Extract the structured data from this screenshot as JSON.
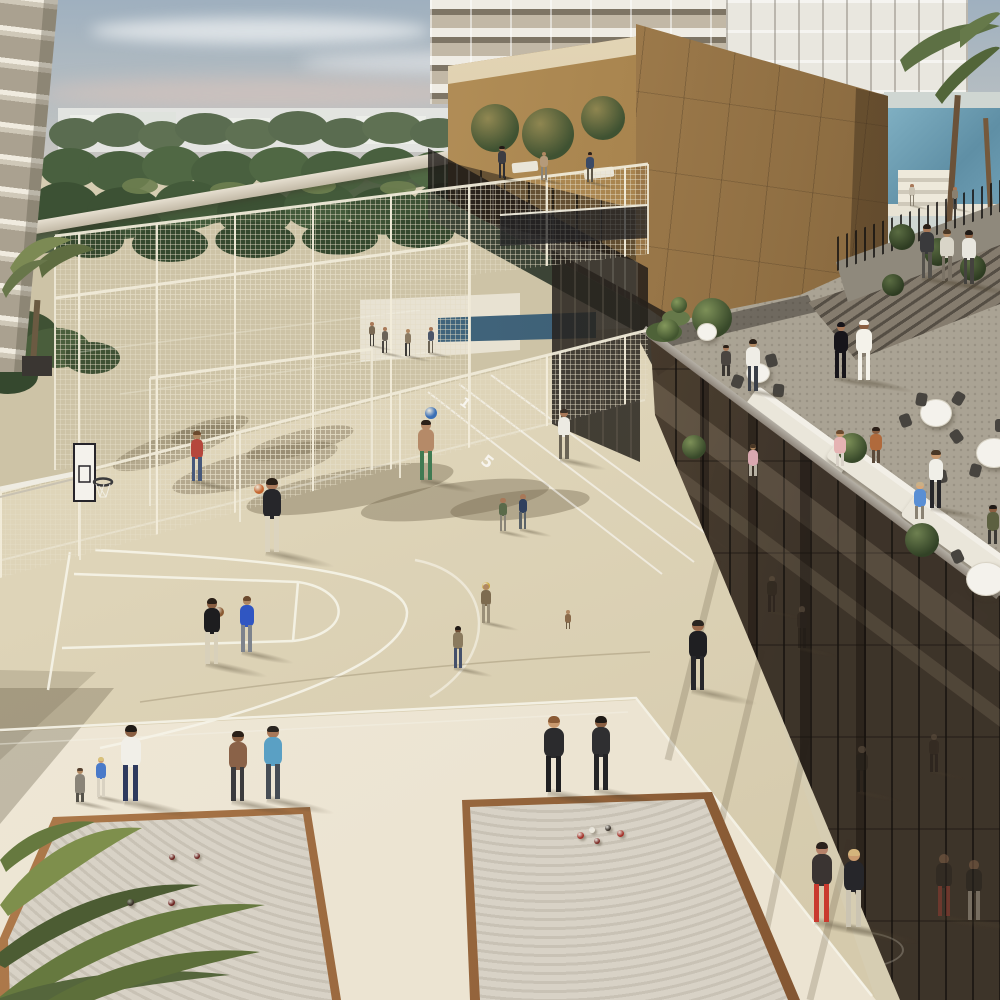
{
  "scene": {
    "width": 1000,
    "height": 1000
  },
  "palette": {
    "sky_top": "#9fb0bf",
    "sky_horizon": "#d8cdc2",
    "cloud": "#e8e6e6",
    "cloud_pink": "#d7c3ba",
    "foliage_far": "#5a6c50",
    "foliage_mid": "#49603f",
    "foliage_near": "#3c5134",
    "distant_city": "#e7e8e4",
    "left_facade": "#d9d2c2",
    "tower_white": "#efece4",
    "gold_facade": "#a37f4e",
    "gold_light": "#c9a76b",
    "gold_dark": "#6f5638",
    "court_beige": "#ded4b8",
    "court_upper": "#cdc3a6",
    "walkway_cream": "#efe8d8",
    "line_white": "#f6f3e8",
    "mesh_fence": "#e9e2d0",
    "bronze_glass_dark": "#3a2f24",
    "bronze_glass_light": "#8c7459",
    "glass_cap": "#a9a49a",
    "terrace_floor": "#b3aca0",
    "sofa_white": "#ece8dc",
    "table_cloth": "#f4f2ec",
    "chair_dark": "#47443f",
    "pool_blue": "#6f9fb5",
    "lap_pool": "#49708a",
    "sand": "#d8d2c6",
    "wood_rim_light": "#b5804f",
    "wood_rim_dark": "#7a4e2c",
    "shadow": "rgba(95,85,62,0.38)"
  },
  "markings": {
    "lane_numbers": [
      {
        "text": "1",
        "x": 460,
        "y": 396,
        "rot": 38,
        "size": 13
      },
      {
        "text": "5",
        "x": 482,
        "y": 452,
        "rot": 38,
        "size": 16
      }
    ]
  },
  "figures": [
    {
      "n": "pool-deck-person-1",
      "x": 912,
      "y": 206,
      "h": 22,
      "top": "#c9c2b2",
      "bot": "#8a8272",
      "skin": "#a87858"
    },
    {
      "n": "pool-deck-person-2",
      "x": 955,
      "y": 209,
      "h": 22,
      "top": "#8a8070",
      "bot": "#5a5450",
      "skin": "#a87858"
    },
    {
      "n": "walkway-person-1",
      "x": 927,
      "y": 278,
      "h": 54,
      "top": "#3a3a3c",
      "bot": "#55524c",
      "skin": "#a87858",
      "hair": "#2a2018"
    },
    {
      "n": "walkway-person-2",
      "x": 947,
      "y": 281,
      "h": 52,
      "top": "#d9d5c8",
      "bot": "#7a7265",
      "skin": "#b08862",
      "hair": "#4a3826"
    },
    {
      "n": "walkway-person-3",
      "x": 969,
      "y": 284,
      "h": 54,
      "top": "#e8e6de",
      "bot": "#44423e",
      "skin": "#8a5f42",
      "hair": "#1f1a16"
    },
    {
      "n": "deck-walker-1",
      "x": 372,
      "y": 346,
      "h": 24,
      "top": "#7a6a55",
      "bot": "#44403a",
      "skin": "#a87858"
    },
    {
      "n": "deck-walker-2",
      "x": 385,
      "y": 353,
      "h": 26,
      "top": "#6a6258",
      "bot": "#4a4540",
      "skin": "#a87858"
    },
    {
      "n": "deck-walker-3",
      "x": 408,
      "y": 356,
      "h": 27,
      "top": "#8a7a62",
      "bot": "#3c3a38",
      "skin": "#b08862"
    },
    {
      "n": "deck-walker-4",
      "x": 431,
      "y": 353,
      "h": 26,
      "top": "#4a5568",
      "bot": "#6b6354",
      "skin": "#a87858"
    },
    {
      "n": "pavilion-guest-1",
      "x": 502,
      "y": 178,
      "h": 32,
      "top": "#3c3c42",
      "bot": "#2e2e33",
      "skin": "#a87858",
      "hair": "#1f1a16"
    },
    {
      "n": "pavilion-guest-2",
      "x": 544,
      "y": 180,
      "h": 28,
      "top": "#b59a7a",
      "bot": "#8a8478",
      "skin": "#b08862"
    },
    {
      "n": "pavilion-guest-3",
      "x": 590,
      "y": 182,
      "h": 30,
      "top": "#3a4a66",
      "bot": "#5d5648",
      "skin": "#a87858",
      "hair": "#2a2018"
    },
    {
      "n": "woman-abaya",
      "x": 841,
      "y": 378,
      "h": 56,
      "top": "#17151a",
      "bot": "#17151a",
      "skin": "#a87858",
      "hair": "#17151a"
    },
    {
      "n": "man-kandura",
      "x": 864,
      "y": 380,
      "h": 60,
      "top": "#f4f2ea",
      "bot": "#f4f2ea",
      "skin": "#8a5f42",
      "hair": "#f4f2ea"
    },
    {
      "n": "terrace-guest-seated-1",
      "x": 726,
      "y": 383,
      "h": 38,
      "pose": "seated",
      "top": "#4a4540",
      "bot": "#3a3632",
      "skin": "#a87858",
      "hair": "#2a2018"
    },
    {
      "n": "terrace-waiter-upper",
      "x": 753,
      "y": 391,
      "h": 52,
      "top": "#efede6",
      "bot": "#3a3f48",
      "skin": "#b08862",
      "hair": "#2a2018"
    },
    {
      "n": "court-walker-white-shirt",
      "x": 564,
      "y": 459,
      "h": 50,
      "top": "#eceae2",
      "bot": "#6b6455",
      "skin": "#a87858",
      "hair": "#3a2f26"
    },
    {
      "n": "kid-plaid-shirt",
      "x": 197,
      "y": 481,
      "h": 50,
      "top": "#b5473c",
      "bot": "#46587a",
      "skin": "#b08862",
      "hair": "#6b4a2e"
    },
    {
      "n": "boy-green-shorts-ball",
      "x": 426,
      "y": 480,
      "h": 60,
      "top": "#b58a68",
      "bot": "#3f7a52",
      "skin": "#b58a68",
      "hair": "#2a2018"
    },
    {
      "n": "terrace-guest-pink-2",
      "x": 753,
      "y": 484,
      "h": 40,
      "pose": "seated",
      "top": "#d9a8b0",
      "bot": "#b8b2a4",
      "skin": "#b08862",
      "hair": "#4a3826"
    },
    {
      "n": "terrace-woman-pink",
      "x": 840,
      "y": 474,
      "h": 44,
      "pose": "seated",
      "top": "#e5b3b3",
      "bot": "#d9d2c8",
      "skin": "#c9996e",
      "hair": "#6b4a2e"
    },
    {
      "n": "terrace-woman-rust",
      "x": 876,
      "y": 471,
      "h": 44,
      "pose": "seated",
      "top": "#b06a3c",
      "bot": "#5a4a3a",
      "skin": "#8a5f42",
      "hair": "#2a1f18"
    },
    {
      "n": "terrace-waiter-apron",
      "x": 936,
      "y": 508,
      "h": 58,
      "top": "#f0efe8",
      "bot": "#26262a",
      "skin": "#c9996e",
      "hair": "#4a3826"
    },
    {
      "n": "court-kid-a",
      "x": 503,
      "y": 531,
      "h": 33,
      "top": "#5a6a4a",
      "bot": "#8a8578",
      "skin": "#a87858"
    },
    {
      "n": "court-kid-b",
      "x": 523,
      "y": 529,
      "h": 35,
      "top": "#30405e",
      "bot": "#5a6268",
      "skin": "#a87858"
    },
    {
      "n": "terrace-man-blue-sofa",
      "x": 920,
      "y": 528,
      "h": 46,
      "pose": "seated",
      "top": "#5a8fd4",
      "bot": "#8a8272",
      "skin": "#d9a878",
      "hair": "#c9b088"
    },
    {
      "n": "terrace-man-green",
      "x": 993,
      "y": 553,
      "h": 48,
      "pose": "seated",
      "top": "#5c6040",
      "bot": "#3c3a36",
      "skin": "#8a5f42",
      "hair": "#1f1a16"
    },
    {
      "n": "basketball-shooter",
      "x": 272,
      "y": 552,
      "h": 74,
      "top": "#26262a",
      "bot": "#dcd4bf",
      "skin": "#a87858",
      "hair": "#2a2118"
    },
    {
      "n": "kid-ball-raised",
      "x": 486,
      "y": 623,
      "h": 39,
      "top": "#7d6b4f",
      "bot": "#9a8f78",
      "skin": "#b08862"
    },
    {
      "n": "toddler-sitting",
      "x": 568,
      "y": 634,
      "h": 24,
      "pose": "seated",
      "top": "#8a6a4a",
      "bot": "#6b5a42",
      "skin": "#b08862"
    },
    {
      "n": "boy-blue-tee",
      "x": 247,
      "y": 652,
      "h": 56,
      "top": "#3056c2",
      "bot": "#7d838c",
      "skin": "#b08862",
      "hair": "#6b4a2e"
    },
    {
      "n": "boy-black-with-ball",
      "x": 212,
      "y": 664,
      "h": 66,
      "top": "#1d1d1f",
      "bot": "#d8d0ba",
      "skin": "#8a5f42",
      "hair": "#2a2018"
    },
    {
      "n": "boy-tan-jeans",
      "x": 458,
      "y": 668,
      "h": 42,
      "top": "#8a7a5e",
      "bot": "#44506b",
      "skin": "#6b4a32",
      "hair": "#1f1a16"
    },
    {
      "n": "jogger-black-outfit",
      "x": 698,
      "y": 690,
      "h": 70,
      "top": "#1f1f22",
      "bot": "#26262a",
      "skin": "#9a6a4c",
      "hair": "#2a2520"
    },
    {
      "n": "woman-crouching",
      "x": 80,
      "y": 802,
      "h": 42,
      "pose": "crouch",
      "top": "#8a8478",
      "bot": "#55524a",
      "skin": "#b08862",
      "hair": "#55402e"
    },
    {
      "n": "kid-blue-shirt",
      "x": 101,
      "y": 797,
      "h": 40,
      "top": "#4a7ac9",
      "bot": "#d9d2c2",
      "skin": "#c99a72",
      "hair": "#d9c27a"
    },
    {
      "n": "man-white-shirt-navy",
      "x": 131,
      "y": 801,
      "h": 76,
      "top": "#f1efe8",
      "bot": "#2e3a5e",
      "skin": "#8a5f42",
      "hair": "#1f1a16"
    },
    {
      "n": "woman-brown-top",
      "x": 238,
      "y": 801,
      "h": 70,
      "top": "#8a6248",
      "bot": "#3b3b3d",
      "skin": "#8a5f42",
      "hair": "#2a2018"
    },
    {
      "n": "man-teal-tee",
      "x": 273,
      "y": 799,
      "h": 73,
      "top": "#5aa0c4",
      "bot": "#474d55",
      "skin": "#a87858",
      "hair": "#2a2520"
    },
    {
      "n": "man-black-casual-1",
      "x": 554,
      "y": 792,
      "h": 76,
      "top": "#2b2b2d",
      "bot": "#202022",
      "skin": "#c9996e",
      "hair": "#8a5a35"
    },
    {
      "n": "man-black-casual-2",
      "x": 601,
      "y": 790,
      "h": 74,
      "top": "#2f2f31",
      "bot": "#242426",
      "skin": "#8a5f42",
      "hair": "#1f1a16"
    },
    {
      "n": "jogger-red-shorts",
      "x": 822,
      "y": 922,
      "h": 80,
      "top": "#3a3432",
      "bot": "#c93a2e",
      "skin": "#b5826a",
      "hair": "#2a211c"
    },
    {
      "n": "jogger-blonde",
      "x": 854,
      "y": 927,
      "h": 78,
      "top": "#26262a",
      "bot": "#cbc4b2",
      "skin": "#c9996e",
      "hair": "#d4b47c"
    }
  ],
  "glass_figures": [
    {
      "n": "gym-silhouette-1",
      "x": 772,
      "y": 612,
      "h": 36,
      "top": "#26201a",
      "bot": "#1d1814",
      "skin": "#6b5a48",
      "op": 0.45
    },
    {
      "n": "gym-silhouette-2",
      "x": 802,
      "y": 648,
      "h": 42,
      "top": "#2a231c",
      "bot": "#201a15",
      "skin": "#6b5a48",
      "op": 0.5
    },
    {
      "n": "gym-silhouette-3",
      "x": 862,
      "y": 792,
      "h": 46,
      "top": "#26201a",
      "bot": "#1d1814",
      "skin": "#6b5a48",
      "op": 0.5
    },
    {
      "n": "gym-silhouette-4",
      "x": 934,
      "y": 772,
      "h": 38,
      "top": "#2a231c",
      "bot": "#1d1814",
      "skin": "#6b5a48",
      "op": 0.45
    },
    {
      "n": "runner-reflection-1",
      "x": 944,
      "y": 916,
      "h": 62,
      "top": "#2a241f",
      "bot": "#8a3a30",
      "skin": "#7a5a44",
      "op": 0.6
    },
    {
      "n": "runner-reflection-2",
      "x": 974,
      "y": 920,
      "h": 60,
      "top": "#26221e",
      "bot": "#9a9284",
      "skin": "#7a5a44",
      "op": 0.6
    }
  ],
  "balls": [
    {
      "n": "basketball-orange",
      "x": 259,
      "y": 489,
      "r": 5,
      "c": "#c4662f"
    },
    {
      "n": "basketball-held",
      "x": 219,
      "y": 612,
      "r": 5,
      "c": "#8a5a32"
    },
    {
      "n": "ball-blue",
      "x": 431,
      "y": 413,
      "r": 6,
      "c": "#3a6fb5"
    },
    {
      "n": "ball-yellow",
      "x": 486,
      "y": 586,
      "r": 4,
      "c": "#c9a53a"
    }
  ],
  "boules": [
    {
      "x": 172,
      "y": 857,
      "r": 3,
      "c": "#6b2320"
    },
    {
      "x": 197,
      "y": 856,
      "r": 3,
      "c": "#6b2320"
    },
    {
      "x": 130,
      "y": 902,
      "r": 3.5,
      "c": "#3a3028"
    },
    {
      "x": 171,
      "y": 902,
      "r": 3.5,
      "c": "#6b2320"
    },
    {
      "x": 580,
      "y": 835,
      "r": 3.5,
      "c": "#a33028"
    },
    {
      "x": 592,
      "y": 830,
      "r": 3,
      "c": "#ece8dc"
    },
    {
      "x": 608,
      "y": 828,
      "r": 3,
      "c": "#3a332c"
    },
    {
      "x": 620,
      "y": 833,
      "r": 3.5,
      "c": "#a33028"
    },
    {
      "x": 597,
      "y": 841,
      "r": 3,
      "c": "#7a2a24"
    }
  ],
  "tables": [
    {
      "x": 935,
      "y": 412,
      "r": 15
    },
    {
      "x": 993,
      "y": 452,
      "r": 17
    },
    {
      "x": 757,
      "y": 372,
      "r": 11
    },
    {
      "x": 985,
      "y": 578,
      "r": 19
    },
    {
      "x": 706,
      "y": 331,
      "r": 9
    }
  ],
  "chairs": [
    {
      "x": 905,
      "y": 420,
      "rot": -20
    },
    {
      "x": 921,
      "y": 399,
      "rot": 10
    },
    {
      "x": 958,
      "y": 398,
      "rot": 30
    },
    {
      "x": 956,
      "y": 436,
      "rot": -35
    },
    {
      "x": 975,
      "y": 470,
      "rot": 15
    },
    {
      "x": 941,
      "y": 476,
      "rot": -10
    },
    {
      "x": 737,
      "y": 381,
      "rot": 20
    },
    {
      "x": 771,
      "y": 360,
      "rot": -15
    },
    {
      "x": 778,
      "y": 390,
      "rot": 5
    },
    {
      "x": 1000,
      "y": 425,
      "rot": 0
    },
    {
      "x": 957,
      "y": 556,
      "rot": -25
    }
  ],
  "plants": [
    {
      "x": 712,
      "y": 318,
      "r": 20,
      "c1": "#7d9058",
      "c2": "#38492a"
    },
    {
      "x": 852,
      "y": 448,
      "r": 15,
      "c1": "#7d9058",
      "c2": "#38492a"
    },
    {
      "x": 922,
      "y": 540,
      "r": 17,
      "c1": "#6e8050",
      "c2": "#324226"
    },
    {
      "x": 694,
      "y": 447,
      "r": 12,
      "c1": "#7d9058",
      "c2": "#38492a"
    },
    {
      "x": 668,
      "y": 330,
      "r": 11,
      "c1": "#84985c",
      "c2": "#42552f"
    },
    {
      "x": 679,
      "y": 305,
      "r": 8,
      "c1": "#84985c",
      "c2": "#42552f"
    },
    {
      "x": 495,
      "y": 128,
      "r": 24,
      "c1": "#74855083",
      "c2": "#3f5232"
    },
    {
      "x": 548,
      "y": 134,
      "r": 26,
      "c1": "#74855083",
      "c2": "#3f5232"
    },
    {
      "x": 603,
      "y": 118,
      "r": 22,
      "c1": "#74855083",
      "c2": "#3f5232"
    },
    {
      "x": 902,
      "y": 237,
      "r": 13,
      "c1": "#5a6c42",
      "c2": "#2e3c22"
    },
    {
      "x": 938,
      "y": 252,
      "r": 14,
      "c1": "#5a6c42",
      "c2": "#2e3c22"
    },
    {
      "x": 973,
      "y": 268,
      "r": 13,
      "c1": "#5a6c42",
      "c2": "#2e3c22"
    },
    {
      "x": 893,
      "y": 285,
      "r": 11,
      "c1": "#5a6c42",
      "c2": "#2e3c22"
    }
  ]
}
